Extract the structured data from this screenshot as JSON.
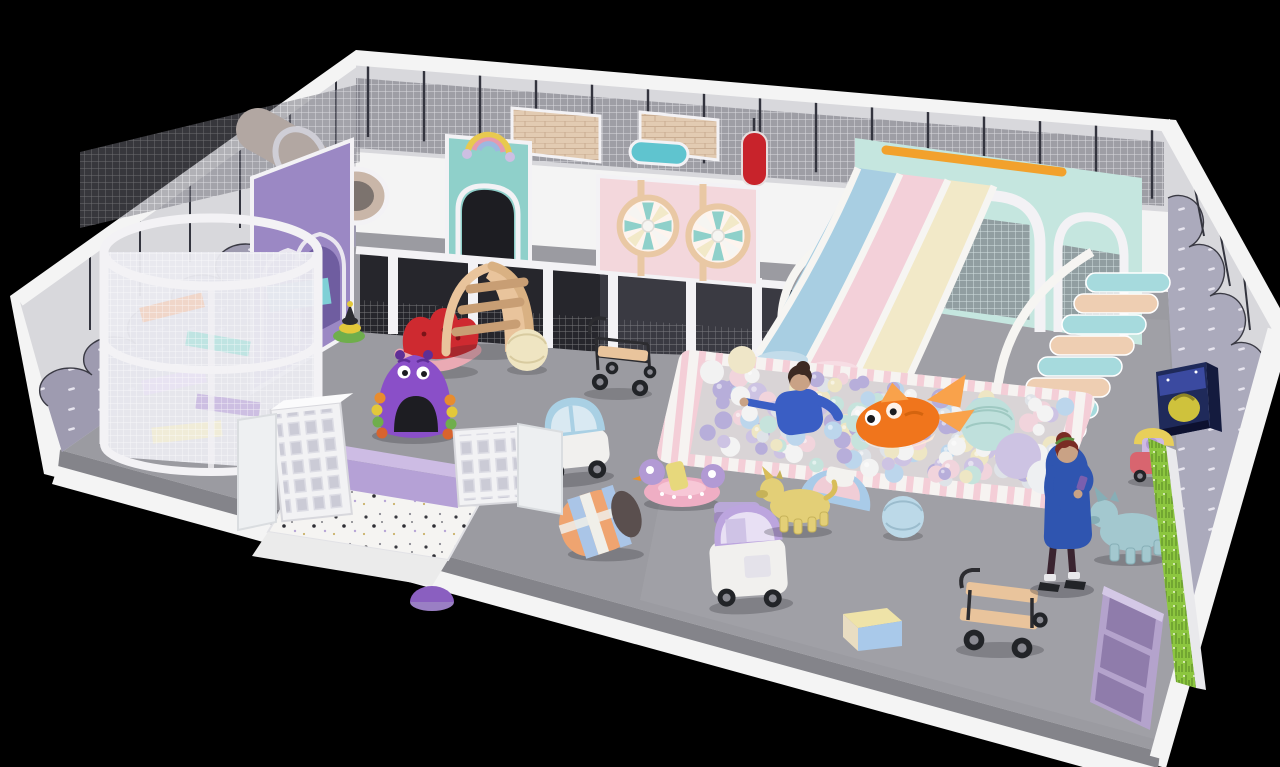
{
  "meta": {
    "scene": "3d-render-indoor-playground",
    "background": "#000000"
  },
  "palette": {
    "bg": "#000000",
    "floor": "#9b9ba1",
    "floorLight": "#a6a6ac",
    "floorSide": "#84848a",
    "rimWhite": "#f4f4f4",
    "wallLight": "#d8d8dc",
    "wallPost": "#33343e",
    "wainscot": "#9e9bb0",
    "wainscotRight": "#abaabc",
    "dash": "#e6e4ee",
    "netBack": "#6e6e78",
    "net": "#ffffff",
    "frame": "#f3f2f5",
    "frameShade": "#cfced6",
    "deckDark": "#26262c",
    "deckDark2": "#3a3a42",
    "opening": "#1d1d22",
    "panelPurple": "#9b88c4",
    "panelPurpleDark": "#6f5da0",
    "panelPink": "#f3d7dc",
    "panelPeachTrim": "#e9c8a4",
    "panelMint": "#8fd0ca",
    "panelMintLight": "#c5e6df",
    "panelBeige": "#e2cbb2",
    "brickLine": "#c9ad92",
    "tube": "#b2a7a2",
    "tubeEnd": "#c9b6a8",
    "tubeDark": "#7c736e",
    "mattressTeal": "#7fd0d6",
    "rollerTeal": "#5fc4cf",
    "punchRed": "#c8232b",
    "slideBlue": "#a8cee2",
    "slidePink": "#f3d0d9",
    "slideCream": "#f2e9c8",
    "rail": "#f6f5f2",
    "stepTeal": "#a6dadd",
    "stepPeach": "#eeceb2",
    "orangeBeam": "#f2a12c",
    "pitRim": "#f6f3f1",
    "pitStripe": "#f4ced7",
    "pitInner": "#d9d4d6",
    "grass": "#8cc63f",
    "grassDark": "#66992c",
    "monster": "#8a4fc8",
    "monsterDark": "#5f2f96",
    "melonRed": "#ce2a30",
    "melonPink": "#eaaab4",
    "wood": "#e9c49c",
    "woodDark": "#c89e74",
    "ballCream": "#efe5c2",
    "ballBlue": "#bcd9e8",
    "carBlue": "#a9d0e4",
    "carPurple": "#bca5de",
    "carBody": "#f1f0ee",
    "glass": "#d9e9f2",
    "glassPurple": "#e8e0f4",
    "barrelOrange": "#efa470",
    "barrelBlue": "#aac5e7",
    "barrelWhite": "#f0efe9",
    "duckPink": "#efaec4",
    "duckYellow": "#e7d87c",
    "duckPurple": "#b29ad4",
    "uniYellow": "#e3cf77",
    "uniYellowDark": "#c6b258",
    "hopperBlue": "#a3c8cf",
    "skin": "#c9a285",
    "coatBlue": "#2f55b0",
    "jacketBlue": "#3a5ec4",
    "hairDark": "#7a2c24",
    "hairKid": "#3c2a22",
    "pants": "#3a2430",
    "shoe": "#222428",
    "fishOrange": "#f0751c",
    "fishLight": "#f9a24b",
    "fishBelly": "#fbe9da",
    "arcadeNavy": "#1f2a5a",
    "arcadeScreen": "#3b4aa0",
    "arcadeYellow": "#cfc23c",
    "stoolPurple": "#b9a8d8",
    "stoolBlue": "#a9cbe8",
    "stoolPink": "#f0cdd6",
    "stoolWhite": "#f3f2ef",
    "cubby": "#b4a3cc",
    "cubbyDark": "#8f7cab",
    "lavWallTop": "#cdbce4",
    "lavWallFront": "#b5a1d6",
    "terrazzoBase": "#f5f4f2",
    "shelfWhite": "#f2f2f4",
    "shadow": "rgba(30,30,38,0.25)",
    "blockTop": "#efe3a8",
    "blockFront": "#a9c9ea",
    "blockSide": "#e9ddc2",
    "rideRed": "#d8656f",
    "rideYellow": "#e8cf5a",
    "cartWire": "#2c2c30",
    "bigBallTeal": "#bfe0dc",
    "bigBallLav": "#cdc3e3",
    "bigBallWhite": "#eef0f2"
  },
  "ball_pit": {
    "count": 175,
    "seed": 7,
    "radius_min": 6,
    "radius_max": 10,
    "colors": [
      "#f3f3f3",
      "#cdc3e3",
      "#c6e3dc",
      "#bcd6ec",
      "#eee6c4",
      "#f1d4dc",
      "#b7aeda",
      "#dfe3e8"
    ],
    "quad": {
      "tl": [
        706,
        364
      ],
      "tr": [
        1076,
        402
      ],
      "br": [
        1046,
        490
      ],
      "bl": [
        690,
        454
      ]
    }
  },
  "stairs": [
    {
      "target": "stairs1",
      "x": 786,
      "y": 332,
      "dx": 8,
      "dy": -14.5,
      "w": 62,
      "h": 15,
      "count": 8,
      "colorA": "#a6dadd",
      "colorB": "#eeceb2"
    },
    {
      "target": "stairs2",
      "x": 1002,
      "y": 420,
      "dx": 12,
      "dy": -21,
      "w": 84,
      "h": 19,
      "count": 8,
      "colorA": "#eeceb2",
      "colorB": "#a6dadd"
    }
  ],
  "back_posts": {
    "x0": 368,
    "x1": 1160,
    "step": 56,
    "len": 72,
    "color": "#33343e"
  },
  "objects": [
    "spiral-net-tower",
    "crawl-tube",
    "purple-arch-panel",
    "mint-arch-panel",
    "rainbow-topper",
    "pink-windmill-panel",
    "windmill-wheel",
    "net-maze-rooms",
    "padded-roller",
    "punch-bag",
    "climb-stairs-teal-peach",
    "slide-blue",
    "slide-pink",
    "slide-cream",
    "orange-top-beam",
    "net-arch-frames",
    "ball-pit",
    "ocean-balls",
    "goldfish-plush",
    "child-in-ball-pit",
    "adult-visitor",
    "duck-teeter-ride",
    "toy-car-blue",
    "toy-car-purple",
    "striped-barrel",
    "rocking-watermelon",
    "wooden-step-climber",
    "purple-monster-tunnel",
    "stacking-ring-toy",
    "play-ball-cream",
    "play-ball-blue",
    "step-stool-set",
    "purple-stool",
    "unicorn-hopper-yellow",
    "unicorn-hopper-blue",
    "wire-cart",
    "wooden-cart",
    "soft-block",
    "arcade-box",
    "kiddie-ride-car",
    "cubby-bench",
    "shoe-cube-shelf",
    "terrazzo-entry",
    "lavender-low-wall",
    "grass-decor-panel"
  ]
}
